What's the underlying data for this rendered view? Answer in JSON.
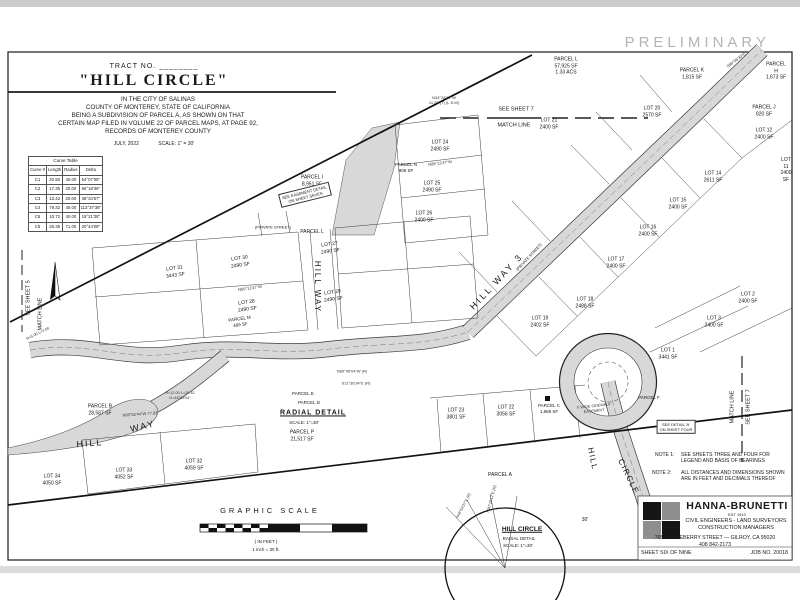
{
  "preliminary": "PRELIMINARY",
  "title_block": {
    "tract_no": "TRACT NO. ________",
    "title": "\"HILL CIRCLE\"",
    "subtitle_lines": [
      "IN THE CITY OF SALINAS",
      "COUNTY OF MONTEREY, STATE OF CALIFORNIA",
      "BEING A SUBDIVISION OF PARCEL A, AS SHOWN ON THAT",
      "CERTAIN MAP FILED IN VOLUME 22 OF PARCEL MAPS, AT PAGE 92,",
      "RECORDS OF MONTEREY COUNTY"
    ],
    "date": "JULY, 2022",
    "scale": "SCALE: 1\" = 30'"
  },
  "curve_table": {
    "title": "Curve Table",
    "headers": [
      "Curve #",
      "Length",
      "Radius",
      "Delta"
    ],
    "rows": [
      [
        "C1",
        "20.50",
        "40.00",
        "54°07'08\""
      ],
      [
        "C2",
        "17.35",
        "20.00",
        "65°18'36\""
      ],
      [
        "C3",
        "13.42",
        "20.00",
        "38°34'57\""
      ],
      [
        "C4",
        "79.32",
        "40.00",
        "113°37'38\""
      ],
      [
        "C5",
        "10.72",
        "40.00",
        "15°21'38\""
      ],
      [
        "C6",
        "25.35",
        "71.00",
        "20°44'08\""
      ]
    ]
  },
  "notes": {
    "note1_label": "NOTE 1:",
    "note1": "SEE SHEETS THREE AND FOUR FOR\nLEGEND AND BASIS OF BEARINGS",
    "note2_label": "NOTE 2:",
    "note2": "ALL DISTANCES AND DIMENSIONS SHOWN\nARE IN FEET AND DECIMALS THEREOF"
  },
  "firm_block": {
    "name": "HANNA-BRUNETTI",
    "est": "EST 1910",
    "line1": "CIVIL ENGINEERS - LAND SURVEYORS",
    "line2": "CONSTRUCTION MANAGERS",
    "address": "7651 EIGLEBERRY STREET — GILROY, CA 95020",
    "phone": "408 842-2173",
    "sheet": "SHEET SIX OF NINE",
    "job": "JOB NO. 20018"
  },
  "colors": {
    "road_gray": "#d8d8d8",
    "line_black": "#1b1b1b",
    "preliminary_gray": "#b4b4b4",
    "logo_gray": "#8e8e8e",
    "logo_black": "#151515"
  },
  "map_labels": [
    {
      "t": "SEE SHEET 7",
      "x": 516,
      "y": 110,
      "fs": 5.5,
      "n": "matchline-label-top-sheet"
    },
    {
      "t": "MATCH LINE",
      "x": 514,
      "y": 126,
      "fs": 5.5,
      "n": "matchline-label-top"
    },
    {
      "t": "SEE SHEET 5",
      "x": 29,
      "y": 298,
      "r": -90,
      "fs": 5.5,
      "n": "matchline-label-left-sheet"
    },
    {
      "t": "MATCH LINE",
      "x": 41,
      "y": 314,
      "r": -90,
      "fs": 5.5,
      "n": "matchline-label-left"
    },
    {
      "t": "MATCH LINE",
      "x": 733,
      "y": 407,
      "r": -90,
      "fs": 5.5,
      "n": "matchline-label-right"
    },
    {
      "t": "SEE SHEET 7",
      "x": 749,
      "y": 407,
      "r": -90,
      "fs": 5.5,
      "n": "matchline-label-right-sheet"
    },
    {
      "t": "HILL WAY",
      "x": 317,
      "y": 287,
      "r": 90,
      "fs": 8,
      "ls": 2,
      "n": "street-label-hill-way"
    },
    {
      "t": "HILL WAY 3",
      "x": 497,
      "y": 282,
      "r": -47,
      "fs": 9,
      "ls": 2.5,
      "n": "street-label-hill-way-3"
    },
    {
      "t": "(PRIVATE STREET)",
      "x": 273,
      "y": 227,
      "fs": 4,
      "n": "private-street-label"
    },
    {
      "t": "(PRIVATE STREET)",
      "x": 529,
      "y": 257,
      "r": -47,
      "fs": 4,
      "n": "private-street-label"
    },
    {
      "t": "HILL",
      "x": 90,
      "y": 444,
      "r": -5,
      "fs": 9,
      "ls": 2,
      "n": "street-label-hill"
    },
    {
      "t": "WAY",
      "x": 143,
      "y": 427,
      "r": -14,
      "fs": 9,
      "ls": 2,
      "n": "street-label-way"
    },
    {
      "t": "HILL",
      "x": 592,
      "y": 459,
      "r": 78,
      "fs": 8,
      "ls": 1.5,
      "n": "street-label-hill-circle-1"
    },
    {
      "t": "CIRCLE",
      "x": 628,
      "y": 477,
      "r": 64,
      "fs": 8,
      "ls": 1.5,
      "n": "street-label-hill-circle-2"
    },
    {
      "t": "PARCEL L\n57,925 SF\n1.33 ACS",
      "x": 566,
      "y": 66,
      "fs": 5,
      "n": "parcel-label"
    },
    {
      "t": "PARCEL K\n1,815 SF",
      "x": 692,
      "y": 74,
      "fs": 5,
      "n": "parcel-label"
    },
    {
      "t": "PARCEL H\n1,673 SF",
      "x": 776,
      "y": 71,
      "fs": 5,
      "n": "parcel-label"
    },
    {
      "t": "LOT 20\n2570 SF",
      "x": 652,
      "y": 112,
      "fs": 5,
      "n": "lot-label"
    },
    {
      "t": "PARCEL J\n820 SF",
      "x": 764,
      "y": 111,
      "fs": 5,
      "n": "parcel-label"
    },
    {
      "t": "LOT 12\n2400 SF",
      "x": 764,
      "y": 134,
      "fs": 5,
      "n": "lot-label"
    },
    {
      "t": "LOT 11\n2400 SF",
      "x": 786,
      "y": 170,
      "fs": 5,
      "n": "lot-label"
    },
    {
      "t": "LOT 14\n2611 SF",
      "x": 713,
      "y": 177,
      "fs": 5,
      "n": "lot-label"
    },
    {
      "t": "LOT 15\n2400 SF",
      "x": 678,
      "y": 204,
      "fs": 5,
      "n": "lot-label"
    },
    {
      "t": "LOT 16\n2400 SF",
      "x": 648,
      "y": 231,
      "fs": 5,
      "n": "lot-label"
    },
    {
      "t": "LOT 17\n2400 SF",
      "x": 616,
      "y": 263,
      "fs": 5,
      "n": "lot-label"
    },
    {
      "t": "LOT 18\n2488 SF",
      "x": 585,
      "y": 303,
      "fs": 5,
      "n": "lot-label"
    },
    {
      "t": "LOT 19\n2402 SF",
      "x": 540,
      "y": 322,
      "fs": 5,
      "n": "lot-label"
    },
    {
      "t": "LOT 21\n2400 SF",
      "x": 549,
      "y": 124,
      "fs": 5,
      "n": "lot-label"
    },
    {
      "t": "LOT 24\n2490 SF",
      "x": 440,
      "y": 146,
      "fs": 5,
      "n": "lot-label"
    },
    {
      "t": "PARCEL N\n906 SF",
      "x": 406,
      "y": 168,
      "fs": 4.5,
      "n": "parcel-label"
    },
    {
      "t": "LOT 25\n2490 SF",
      "x": 432,
      "y": 187,
      "fs": 5,
      "n": "lot-label"
    },
    {
      "t": "LOT 26\n2400 SF",
      "x": 424,
      "y": 217,
      "fs": 5,
      "n": "lot-label"
    },
    {
      "t": "PARCEL I\n8,951 SF",
      "x": 312,
      "y": 181,
      "fs": 5,
      "n": "parcel-label"
    },
    {
      "t": "LOT 30\n2490 SF",
      "x": 240,
      "y": 262,
      "r": -8,
      "fs": 5,
      "n": "lot-label"
    },
    {
      "t": "LOT 27\n2490 SF",
      "x": 330,
      "y": 248,
      "r": -8,
      "fs": 5,
      "n": "lot-label"
    },
    {
      "t": "LOT 28\n2490 SF",
      "x": 247,
      "y": 306,
      "r": -8,
      "fs": 5,
      "n": "lot-label"
    },
    {
      "t": "LOT 29\n2490 SF",
      "x": 333,
      "y": 296,
      "r": -8,
      "fs": 5,
      "n": "lot-label"
    },
    {
      "t": "PARCEL M\n489 SF",
      "x": 240,
      "y": 322,
      "r": -8,
      "fs": 4.5,
      "n": "parcel-label"
    },
    {
      "t": "LOT 31\n3443 SF",
      "x": 175,
      "y": 272,
      "r": -8,
      "fs": 5,
      "n": "lot-label"
    },
    {
      "t": "PARCEL B\n28,587 SF",
      "x": 100,
      "y": 410,
      "fs": 5,
      "n": "parcel-label"
    },
    {
      "t": "LOT 34\n4050 SF",
      "x": 52,
      "y": 480,
      "fs": 5,
      "n": "lot-label"
    },
    {
      "t": "LOT 33\n4052 SF",
      "x": 124,
      "y": 474,
      "fs": 5,
      "n": "lot-label"
    },
    {
      "t": "LOT 32\n4059 SF",
      "x": 194,
      "y": 465,
      "fs": 5,
      "n": "lot-label"
    },
    {
      "t": "LOT 23\n3801 SF",
      "x": 456,
      "y": 414,
      "fs": 5,
      "n": "lot-label"
    },
    {
      "t": "LOT 22\n3056 SF",
      "x": 506,
      "y": 411,
      "fs": 5,
      "n": "lot-label"
    },
    {
      "t": "PARCEL C\n1,868 SF",
      "x": 549,
      "y": 409,
      "fs": 4.5,
      "n": "parcel-label"
    },
    {
      "t": "PARCEL A",
      "x": 500,
      "y": 475,
      "fs": 5,
      "n": "parcel-label"
    },
    {
      "t": "PARCEL E",
      "x": 303,
      "y": 394,
      "fs": 4.5,
      "n": "parcel-label"
    },
    {
      "t": "PARCEL D",
      "x": 309,
      "y": 403,
      "fs": 4.5,
      "n": "parcel-label"
    },
    {
      "t": "PARCEL P\n21,517 SF",
      "x": 302,
      "y": 436,
      "fs": 5,
      "n": "parcel-label"
    },
    {
      "t": "PARCEL F",
      "x": 649,
      "y": 398,
      "fs": 4.5,
      "n": "parcel-label"
    },
    {
      "t": "LOT 1\n3441 SF",
      "x": 668,
      "y": 354,
      "fs": 5,
      "n": "lot-label"
    },
    {
      "t": "LOT 2\n2400 SF",
      "x": 748,
      "y": 298,
      "fs": 5,
      "n": "lot-label"
    },
    {
      "t": "LOT 3\n2400 SF",
      "x": 714,
      "y": 322,
      "fs": 5,
      "n": "lot-label"
    },
    {
      "t": "PARCEL L",
      "x": 312,
      "y": 232,
      "fs": 5,
      "n": "parcel-label"
    },
    {
      "t": "RADIAL DETAIL",
      "x": 313,
      "y": 413,
      "fs": 7,
      "ls": 1,
      "cls": "b u",
      "n": "radial-detail-title"
    },
    {
      "t": "SCALE: 1\"=30'",
      "x": 304,
      "y": 423,
      "fs": 4.5,
      "n": "radial-detail-scale"
    },
    {
      "t": "HILL CIRCLE",
      "x": 522,
      "y": 530,
      "fs": 6.5,
      "cls": "b u",
      "n": "hill-circle-detail-title"
    },
    {
      "t": "RADIAL DETAIL",
      "x": 519,
      "y": 539,
      "fs": 4.5,
      "n": "hill-circle-detail-sub"
    },
    {
      "t": "SCALE: 1\"=30'",
      "x": 518,
      "y": 546,
      "fs": 4.5,
      "n": "hill-circle-detail-scale"
    },
    {
      "t": "GRAPHIC SCALE",
      "x": 270,
      "y": 511,
      "fs": 7.5,
      "ls": 3,
      "n": "graphic-scale-title"
    },
    {
      "t": "( IN FEET )",
      "x": 266,
      "y": 542,
      "fs": 4.5,
      "n": "graphic-scale-units"
    },
    {
      "t": "1 inch = 30 ft.",
      "x": 266,
      "y": 550,
      "fs": 4.5,
      "n": "graphic-scale-ratio"
    },
    {
      "t": "30'",
      "x": 585,
      "y": 520,
      "fs": 5,
      "n": "dimension-30ft"
    },
    {
      "t": "SEE EASEMENT DETAIL\nON SHEET SEVEN",
      "x": 305,
      "y": 195,
      "r": -14,
      "fs": 4,
      "cls": "boxed",
      "n": "easement-detail-note"
    },
    {
      "t": "SEE DETAIL 'A'\nON SHEET FOUR",
      "x": 676,
      "y": 427,
      "fs": 4,
      "cls": "boxed",
      "n": "detail-a-note"
    },
    {
      "t": "4' WIDE SIDEWALK\nEASEMENT",
      "x": 594,
      "y": 409,
      "r": -6,
      "fs": 3.8,
      "cls": "dim",
      "n": "sidewalk-easement-note"
    },
    {
      "t": "N34°28'17\"W\n11.20 (T) (L.S.M)",
      "x": 444,
      "y": 100,
      "fs": 4,
      "cls": "dim",
      "n": "bearing-annotation"
    },
    {
      "t": "N89°12'47\"W",
      "x": 440,
      "y": 163,
      "r": -7,
      "fs": 4,
      "cls": "dim",
      "n": "bearing-annotation"
    },
    {
      "t": "N89°12'47\"W",
      "x": 250,
      "y": 288,
      "r": -8,
      "fs": 4,
      "cls": "dim",
      "n": "bearing-annotation"
    },
    {
      "t": "S89°08'30\"E",
      "x": 736,
      "y": 60,
      "r": -37,
      "fs": 4,
      "cls": "dim",
      "n": "bearing-annotation"
    },
    {
      "t": "N89°52'44\"W 77.83",
      "x": 140,
      "y": 414,
      "r": -4,
      "fs": 4,
      "cls": "dim",
      "n": "bearing-annotation"
    },
    {
      "t": "R=12.00 L=20.42\nD=48°05'04\"",
      "x": 180,
      "y": 396,
      "fs": 3.8,
      "cls": "dim",
      "n": "curve-annotation"
    },
    {
      "t": "R=5.00 L=4.56",
      "x": 38,
      "y": 334,
      "r": -26,
      "fs": 3.8,
      "cls": "dim",
      "n": "curve-annotation"
    },
    {
      "t": "N89°45'04\"W (R)",
      "x": 352,
      "y": 371,
      "fs": 4,
      "cls": "dim",
      "n": "radial-bearing-annotation"
    },
    {
      "t": "S11°36'34\"E (R)",
      "x": 356,
      "y": 383,
      "fs": 4,
      "cls": "dim",
      "n": "radial-bearing-annotation"
    },
    {
      "t": "N49°53'37\"E (R)",
      "x": 464,
      "y": 506,
      "r": -62,
      "fs": 3.8,
      "cls": "dim",
      "n": "radial-bearing-annotation"
    },
    {
      "t": "N30°18'12\"E (R)",
      "x": 492,
      "y": 499,
      "r": -75,
      "fs": 3.8,
      "cls": "dim",
      "n": "radial-bearing-annotation"
    }
  ]
}
